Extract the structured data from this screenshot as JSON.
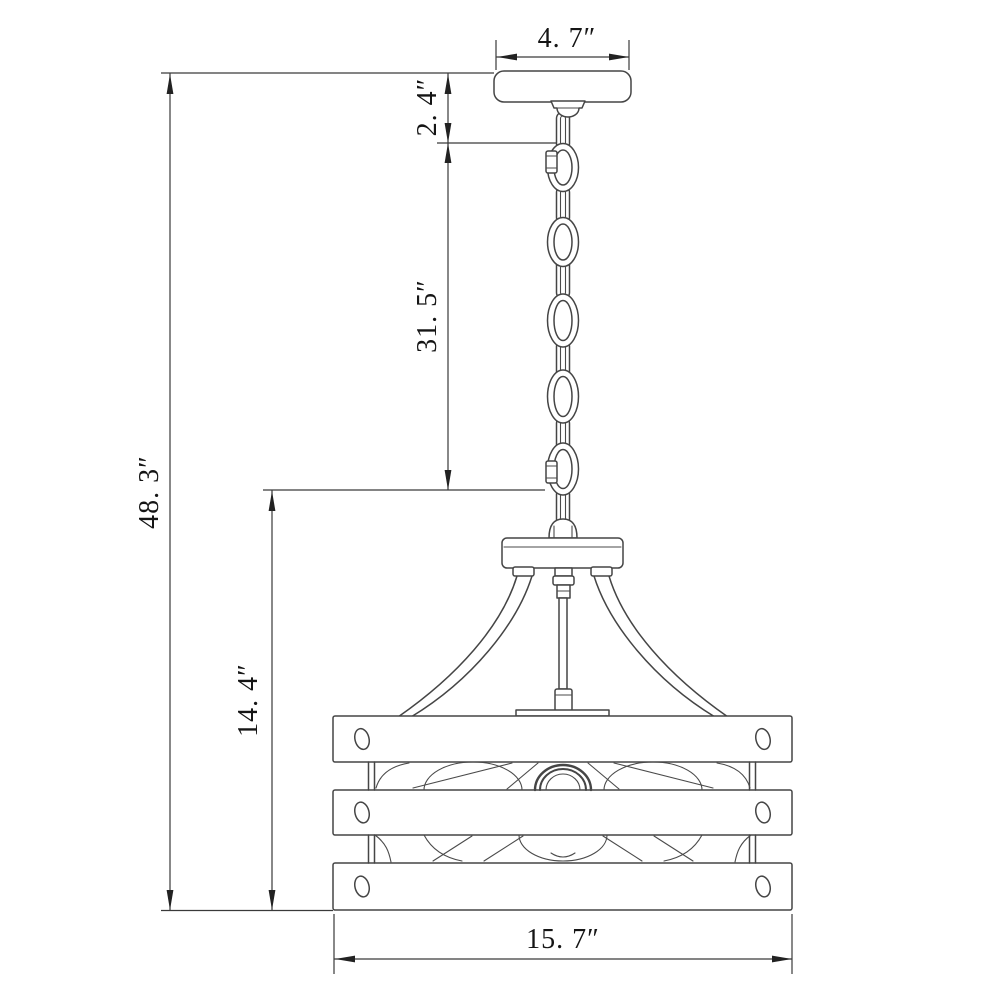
{
  "canvas": {
    "background": "#ffffff",
    "object_line_color": "#454545",
    "dimension_line_color": "#3a3a3a",
    "text_color": "#151515"
  },
  "drawing": {
    "subject": "pendant-light-fixture-dimension-drawing",
    "unit": "inches",
    "components": [
      "ceiling-canopy",
      "hanging-chain",
      "quick-link-connectors",
      "fixture-holder",
      "support-arms",
      "center-stem",
      "slatted-drum-shade",
      "light-bulbs"
    ],
    "dimensions": {
      "canopy_width": {
        "label": "4. 7″",
        "inches": 4.7
      },
      "canopy_drop": {
        "label": "2. 4″",
        "inches": 2.4
      },
      "chain_length": {
        "label": "31. 5″",
        "inches": 31.5
      },
      "overall_height": {
        "label": "48. 3″",
        "inches": 48.3
      },
      "fixture_height": {
        "label": "14. 4″",
        "inches": 14.4
      },
      "fixture_width": {
        "label": "15. 7″",
        "inches": 15.7
      }
    }
  }
}
